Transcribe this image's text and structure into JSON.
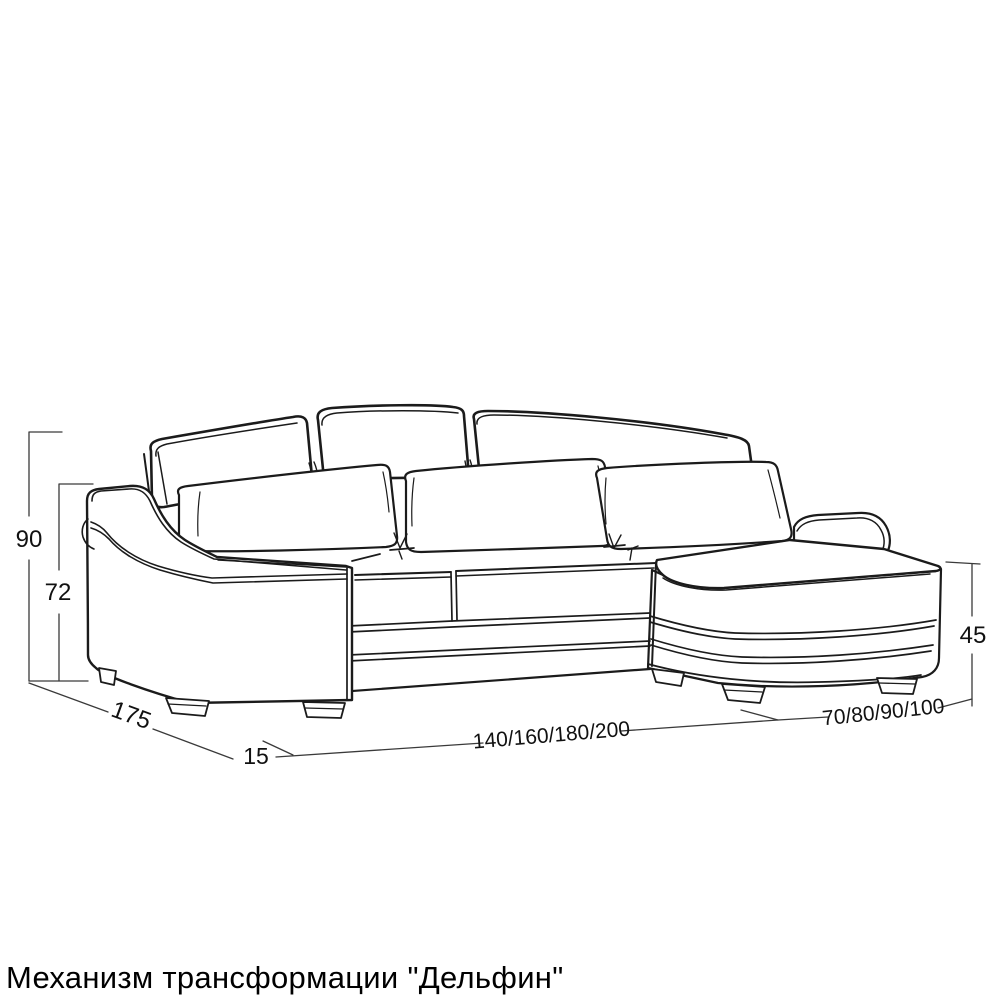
{
  "drawing": {
    "caption": "Механизм трансформации \"Дельфин\"",
    "dimensions": {
      "total_height": "90",
      "seat_back_height": "72",
      "depth": "175",
      "armrest_front_width": "15",
      "bed_length_options": "140/160/180/200",
      "chaise_width_options": "70/80/90/100",
      "chaise_height": "45"
    },
    "colors": {
      "ink": "#1b1b1b",
      "dimension_lines": "#3a3a3a",
      "background": "#ffffff"
    }
  }
}
